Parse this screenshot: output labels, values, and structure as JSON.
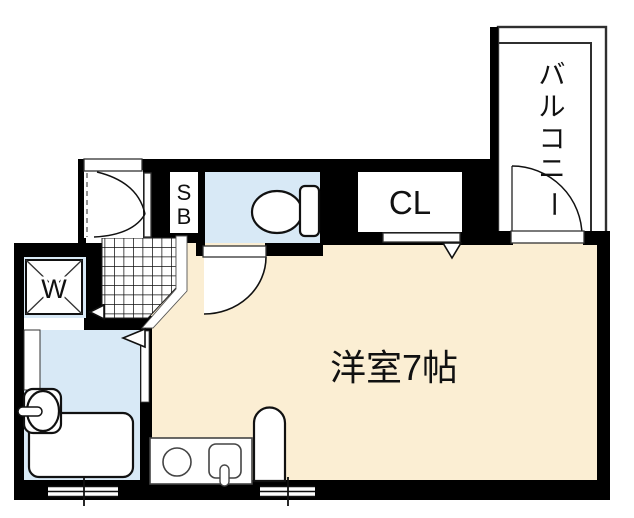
{
  "plan": {
    "rooms": {
      "western_room": {
        "label": "洋室7帖"
      },
      "balcony": {
        "label": "バルコニー",
        "chars": [
          "バ",
          "ル",
          "コ",
          "ニ",
          "ー"
        ]
      },
      "closet": {
        "label": "CL"
      },
      "shoe_box": {
        "label": "SB",
        "chars": [
          "S",
          "B"
        ]
      },
      "washer_pan": {
        "label": "W"
      }
    },
    "colors": {
      "wall": "#000000",
      "room_fill": "#FBEED3",
      "wet_area_fill": "#D8E9F6",
      "background": "#FFFFFF"
    }
  }
}
